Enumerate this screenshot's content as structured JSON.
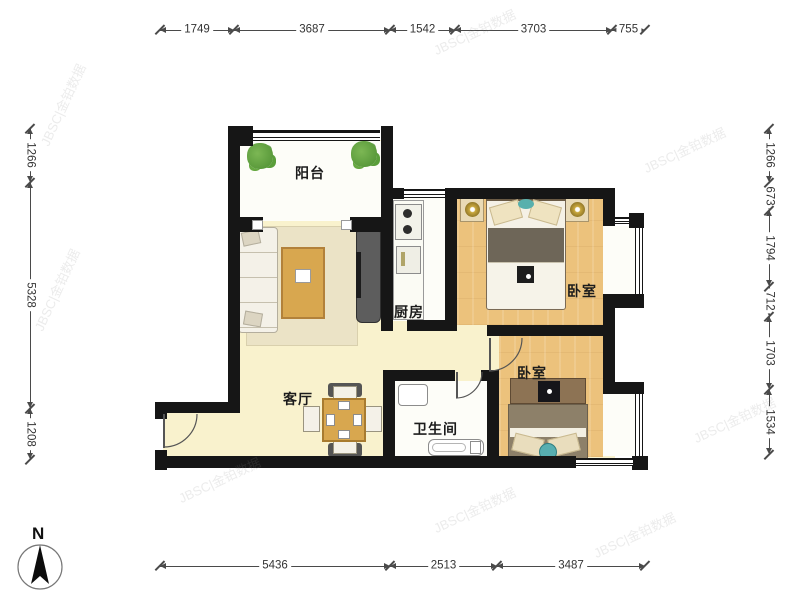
{
  "title": "两居室户型图",
  "compass": {
    "label": "N"
  },
  "watermark": {
    "text": "JBSC|金铂数据"
  },
  "rooms": {
    "balcony": {
      "label": "阳台"
    },
    "living": {
      "label": "客厅"
    },
    "kitchen": {
      "label": "厨房"
    },
    "bedroom_top": {
      "label": "卧室"
    },
    "bedroom_bottom": {
      "label": "卧室"
    },
    "bathroom": {
      "label": "卫生间"
    }
  },
  "dimensions": {
    "top": {
      "labels": [
        "1749",
        "3687",
        "1542",
        "3703",
        "755"
      ]
    },
    "bottom": {
      "labels": [
        "5436",
        "2513",
        "3487"
      ]
    },
    "left": {
      "labels": [
        "1266",
        "5328",
        "1208"
      ]
    },
    "right": {
      "labels": [
        "1266",
        "673",
        "1794",
        "712",
        "1703",
        "1534"
      ]
    }
  }
}
